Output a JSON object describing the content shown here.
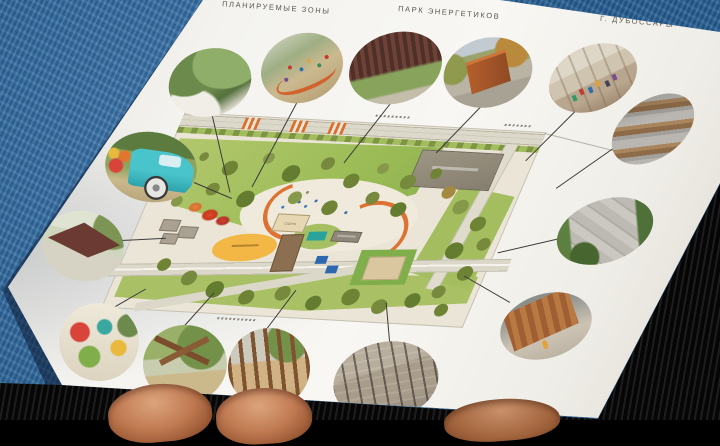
{
  "document": {
    "header": {
      "left_label": "ПЛАНИРУЕМЫЕ ЗОНЫ",
      "center_label": "ПАРК ЭНЕРГЕТИКОВ",
      "right_label": "Г. ДУБОССАРЫ"
    },
    "map": {
      "stage_label": "СЦЕНА"
    },
    "legend_photos": [
      {
        "id": "planting-white-wall",
        "subject": "green planting beds with white curved retaining wall"
      },
      {
        "id": "kids-orange-bench",
        "subject": "children around curved orange bench"
      },
      {
        "id": "dark-red-pergola",
        "subject": "large dark-red pergola canopy over lawn"
      },
      {
        "id": "corten-kiosk",
        "subject": "rust corten-steel kiosk among autumn trees"
      },
      {
        "id": "white-pavilion-market",
        "subject": "light pavilion interior with people"
      },
      {
        "id": "wooden-terrace-steps",
        "subject": "tiered wooden seating steps"
      },
      {
        "id": "aerial-slab-path",
        "subject": "aerial view of concrete slab path in greenery"
      },
      {
        "id": "wooden-wall-kid",
        "subject": "tall timber plank wall with child"
      },
      {
        "id": "net-posts-court",
        "subject": "grey court with poles and climbing nets"
      },
      {
        "id": "timber-pole-playground",
        "subject": "vertical timber pole play structure on sand"
      },
      {
        "id": "log-play-structure",
        "subject": "crossed log playground on grass"
      },
      {
        "id": "colorful-playground-drawing",
        "subject": "colorful playground illustration"
      },
      {
        "id": "angular-roof-pavilion",
        "subject": "pavilion with angular dark-red roof"
      },
      {
        "id": "teal-retro-van",
        "subject": "turquoise retro van flower stall"
      }
    ]
  },
  "colors": {
    "fabric_blue": "#2b6aa3",
    "paper_white": "#f4f3ef",
    "lawn_green": "#9dbd58",
    "tree_olive": "#76893c",
    "accent_orange": "#dd7233",
    "court_green": "#7fae4a",
    "table_blue": "#2d67ae",
    "playground_yellow": "#f2b744",
    "stage_beige": "#e7d8b3",
    "skin_tone": "#c07a52",
    "table_black": "#060606"
  }
}
